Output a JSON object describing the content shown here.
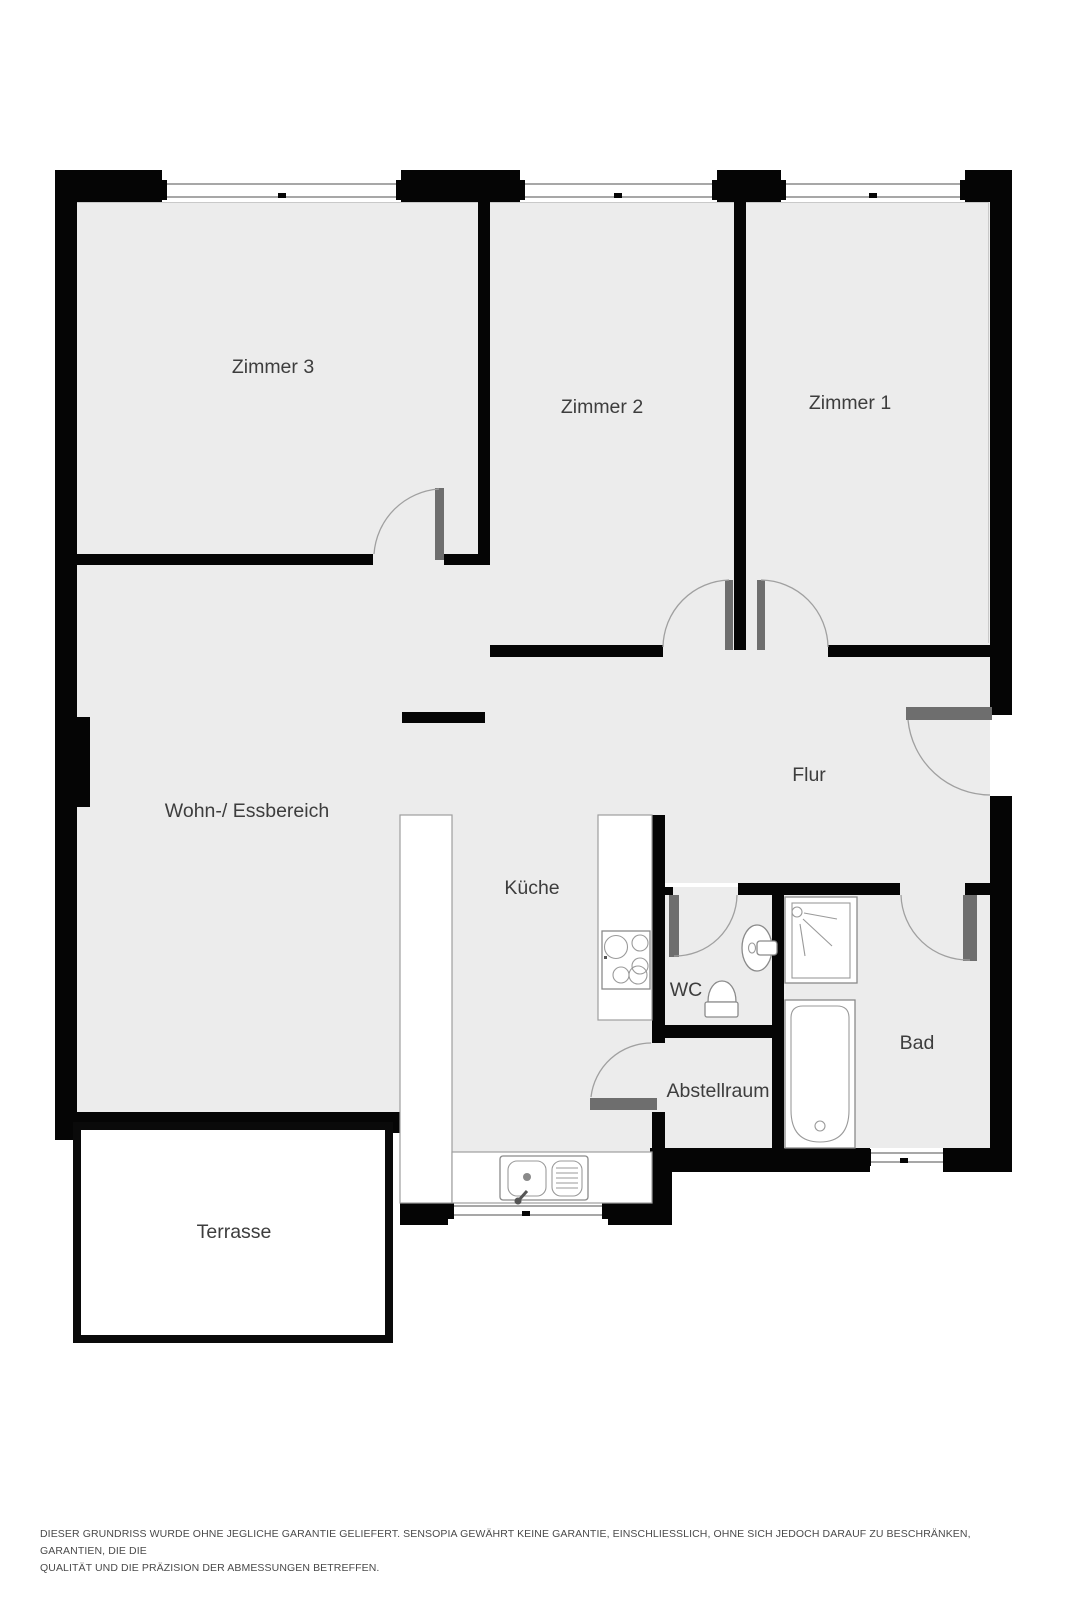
{
  "document": {
    "kind": "apartment-floor-plan",
    "language": "de"
  },
  "rooms": {
    "zimmer3": {
      "label": "Zimmer 3"
    },
    "zimmer2": {
      "label": "Zimmer 2"
    },
    "zimmer1": {
      "label": "Zimmer 1"
    },
    "wohn_essbereich": {
      "label": "Wohn-/ Essbereich"
    },
    "flur": {
      "label": "Flur"
    },
    "kueche": {
      "label": "Küche"
    },
    "wc": {
      "label": "WC"
    },
    "bad": {
      "label": "Bad"
    },
    "abstellraum": {
      "label": "Abstellraum"
    },
    "terrasse": {
      "label": "Terrasse"
    }
  },
  "fixtures": [
    "shower",
    "bathtub",
    "toilet",
    "wash-basin",
    "cooktop",
    "kitchen-sink",
    "kitchen-counter"
  ],
  "openings": {
    "doors": 7,
    "windows": 5
  },
  "disclaimer": {
    "line1": "DIESER GRUNDRISS WURDE OHNE JEGLICHE GARANTIE GELIEFERT. SENSOPIA GEWÄHRT KEINE GARANTIE, EINSCHLIESSLICH, OHNE SICH JEDOCH DARAUF ZU BESCHRÄNKEN, GARANTIEN, DIE DIE",
    "line2": "QUALITÄT UND DIE PRÄZISION DER ABMESSUNGEN BETREFFEN."
  },
  "colors": {
    "background": "#ffffff",
    "wall": "#050505",
    "floor": "#ececec",
    "door_leaf": "#6e6e6e",
    "swing_arc": "#a0a0a0",
    "fixture_stroke": "#8a8a8a",
    "label_text": "#3d3d3d",
    "disclaimer_text": "#4a4a4a"
  }
}
